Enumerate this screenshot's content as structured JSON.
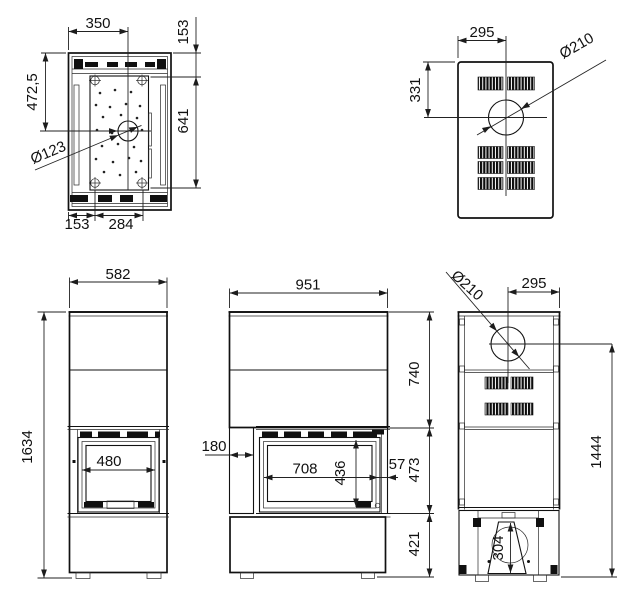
{
  "colors": {
    "line": "#111111",
    "background": "#ffffff"
  },
  "views": {
    "top_section": {
      "dims": {
        "width_to_flue": "350",
        "front_depth": "153",
        "flue_from_front": "472,5",
        "plate_depth": "641",
        "flue_diameter": "Ø123",
        "bolt_offset": "153",
        "bolt_spacing": "284"
      }
    },
    "top_rear": {
      "dims": {
        "flue_from_side": "295",
        "flue_from_top": "331",
        "flue_diameter": "Ø210"
      }
    },
    "front": {
      "dims": {
        "width": "582",
        "height": "1634",
        "glass_width": "480"
      }
    },
    "side": {
      "dims": {
        "depth": "951",
        "top_section": "740",
        "front_column": "180",
        "glass_width": "708",
        "glass_height": "436",
        "rear_gap": "57",
        "firebox_section": "473",
        "base_height": "421"
      }
    },
    "back": {
      "dims": {
        "flue_diameter": "Ø210",
        "flue_from_edge": "295",
        "flue_to_floor": "1444",
        "pedestal_height": "304"
      }
    }
  }
}
